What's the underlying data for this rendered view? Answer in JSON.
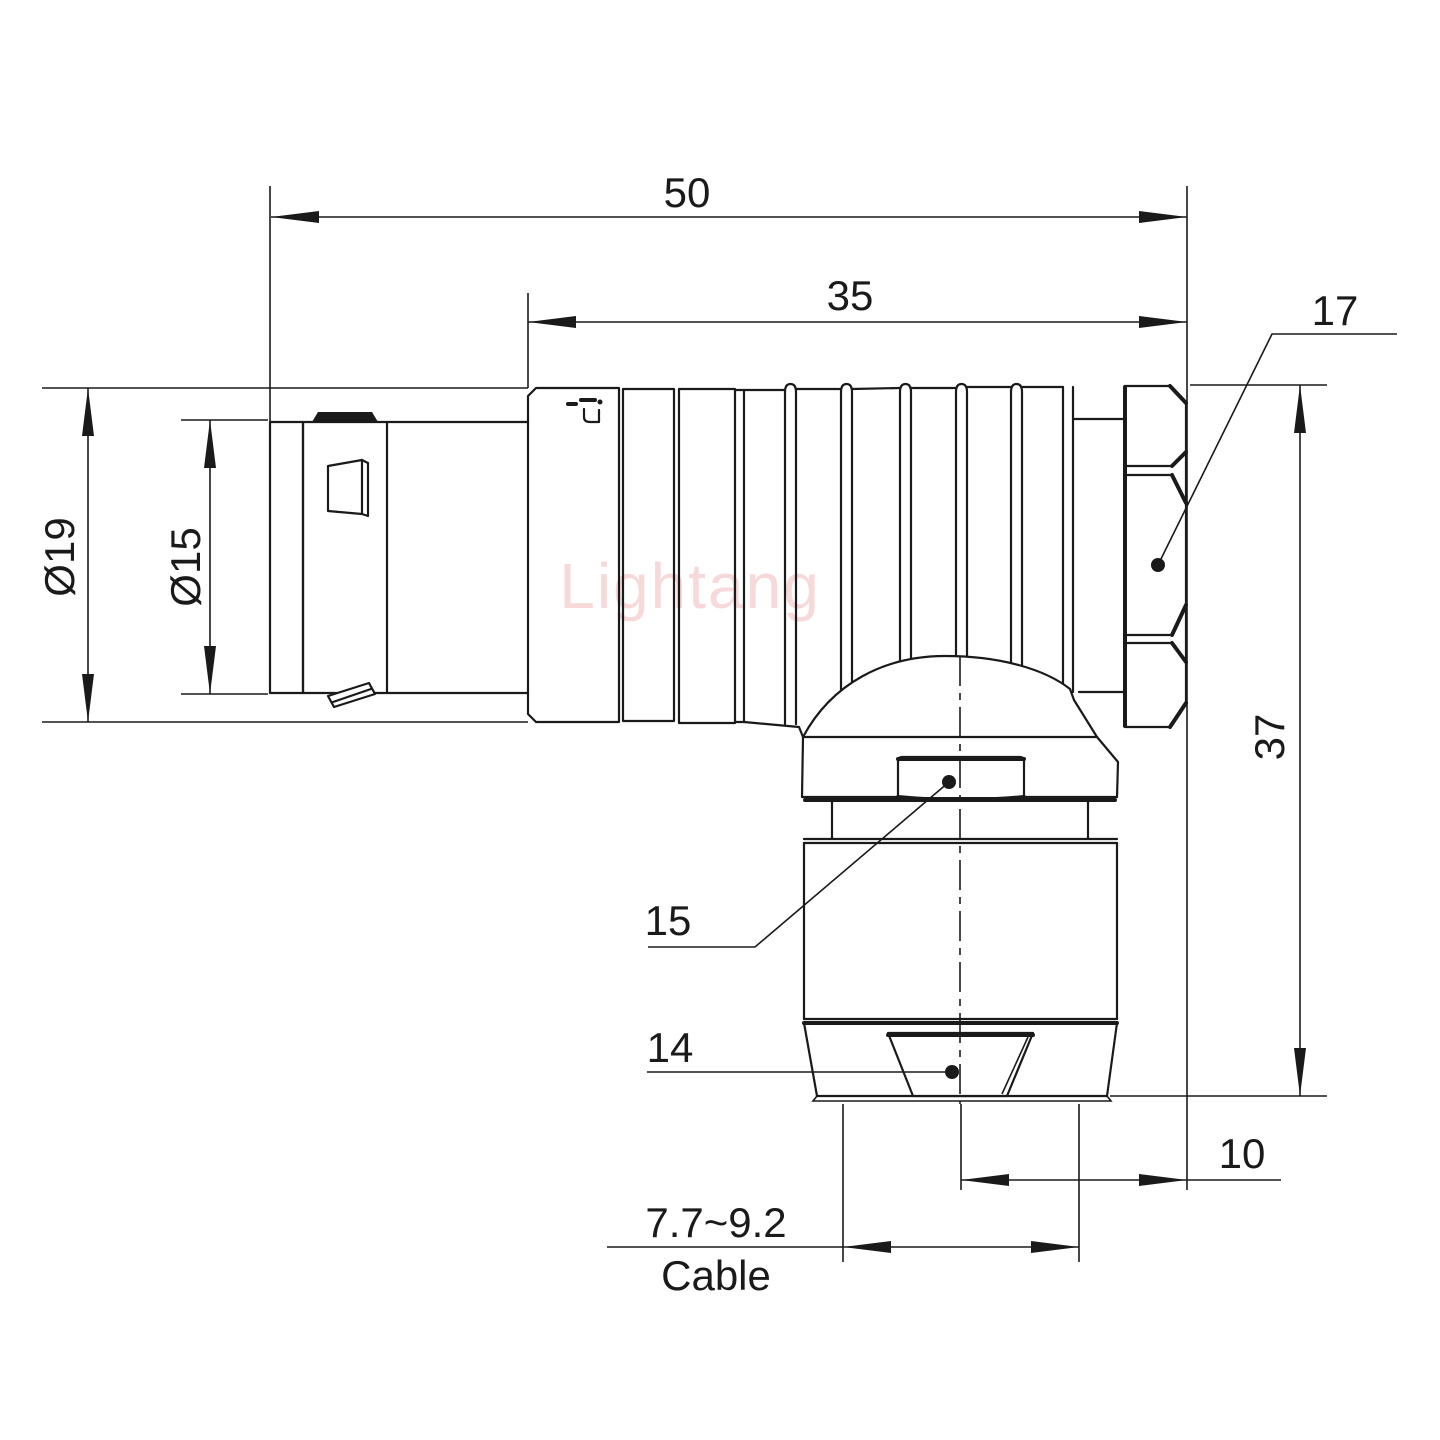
{
  "drawing": {
    "watermark": "Lightang",
    "labels": {
      "overall_length": "50",
      "body_length": "35",
      "hex_nut_flats": "17",
      "outer_diameter": "Ø19",
      "mating_diameter": "Ø15",
      "total_height": "37",
      "collar_flats": "15",
      "clamp_nut_flats": "14",
      "axis_to_back": "10",
      "cable_diameter_range": "7.7~9.2",
      "cable_caption": "Cable"
    },
    "colors": {
      "line": "#1a1a1a",
      "watermark_pink": "#f0b4b4",
      "background": "#ffffff"
    }
  }
}
